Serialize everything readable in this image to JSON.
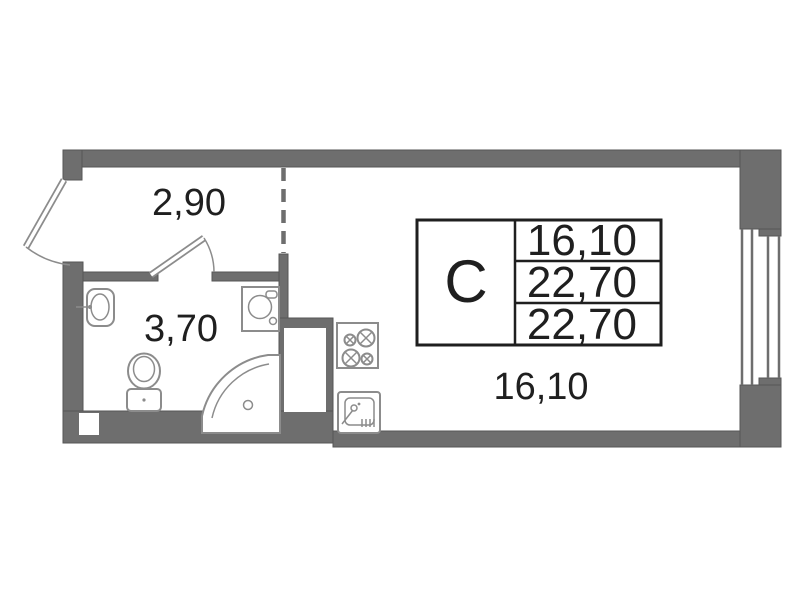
{
  "plan": {
    "title": "Studio apartment floor plan",
    "labels": {
      "hall_width": "2,90",
      "bathroom_area": "3,70",
      "room_area": "16,10"
    },
    "info_table": {
      "type": "С",
      "values": [
        "16,10",
        "22,70",
        "22,70"
      ]
    },
    "colors": {
      "wall": "#6e6e6e",
      "wall_edge": "#565656",
      "fixture": "#8c8c8c",
      "ink": "#1f1f1f"
    }
  }
}
